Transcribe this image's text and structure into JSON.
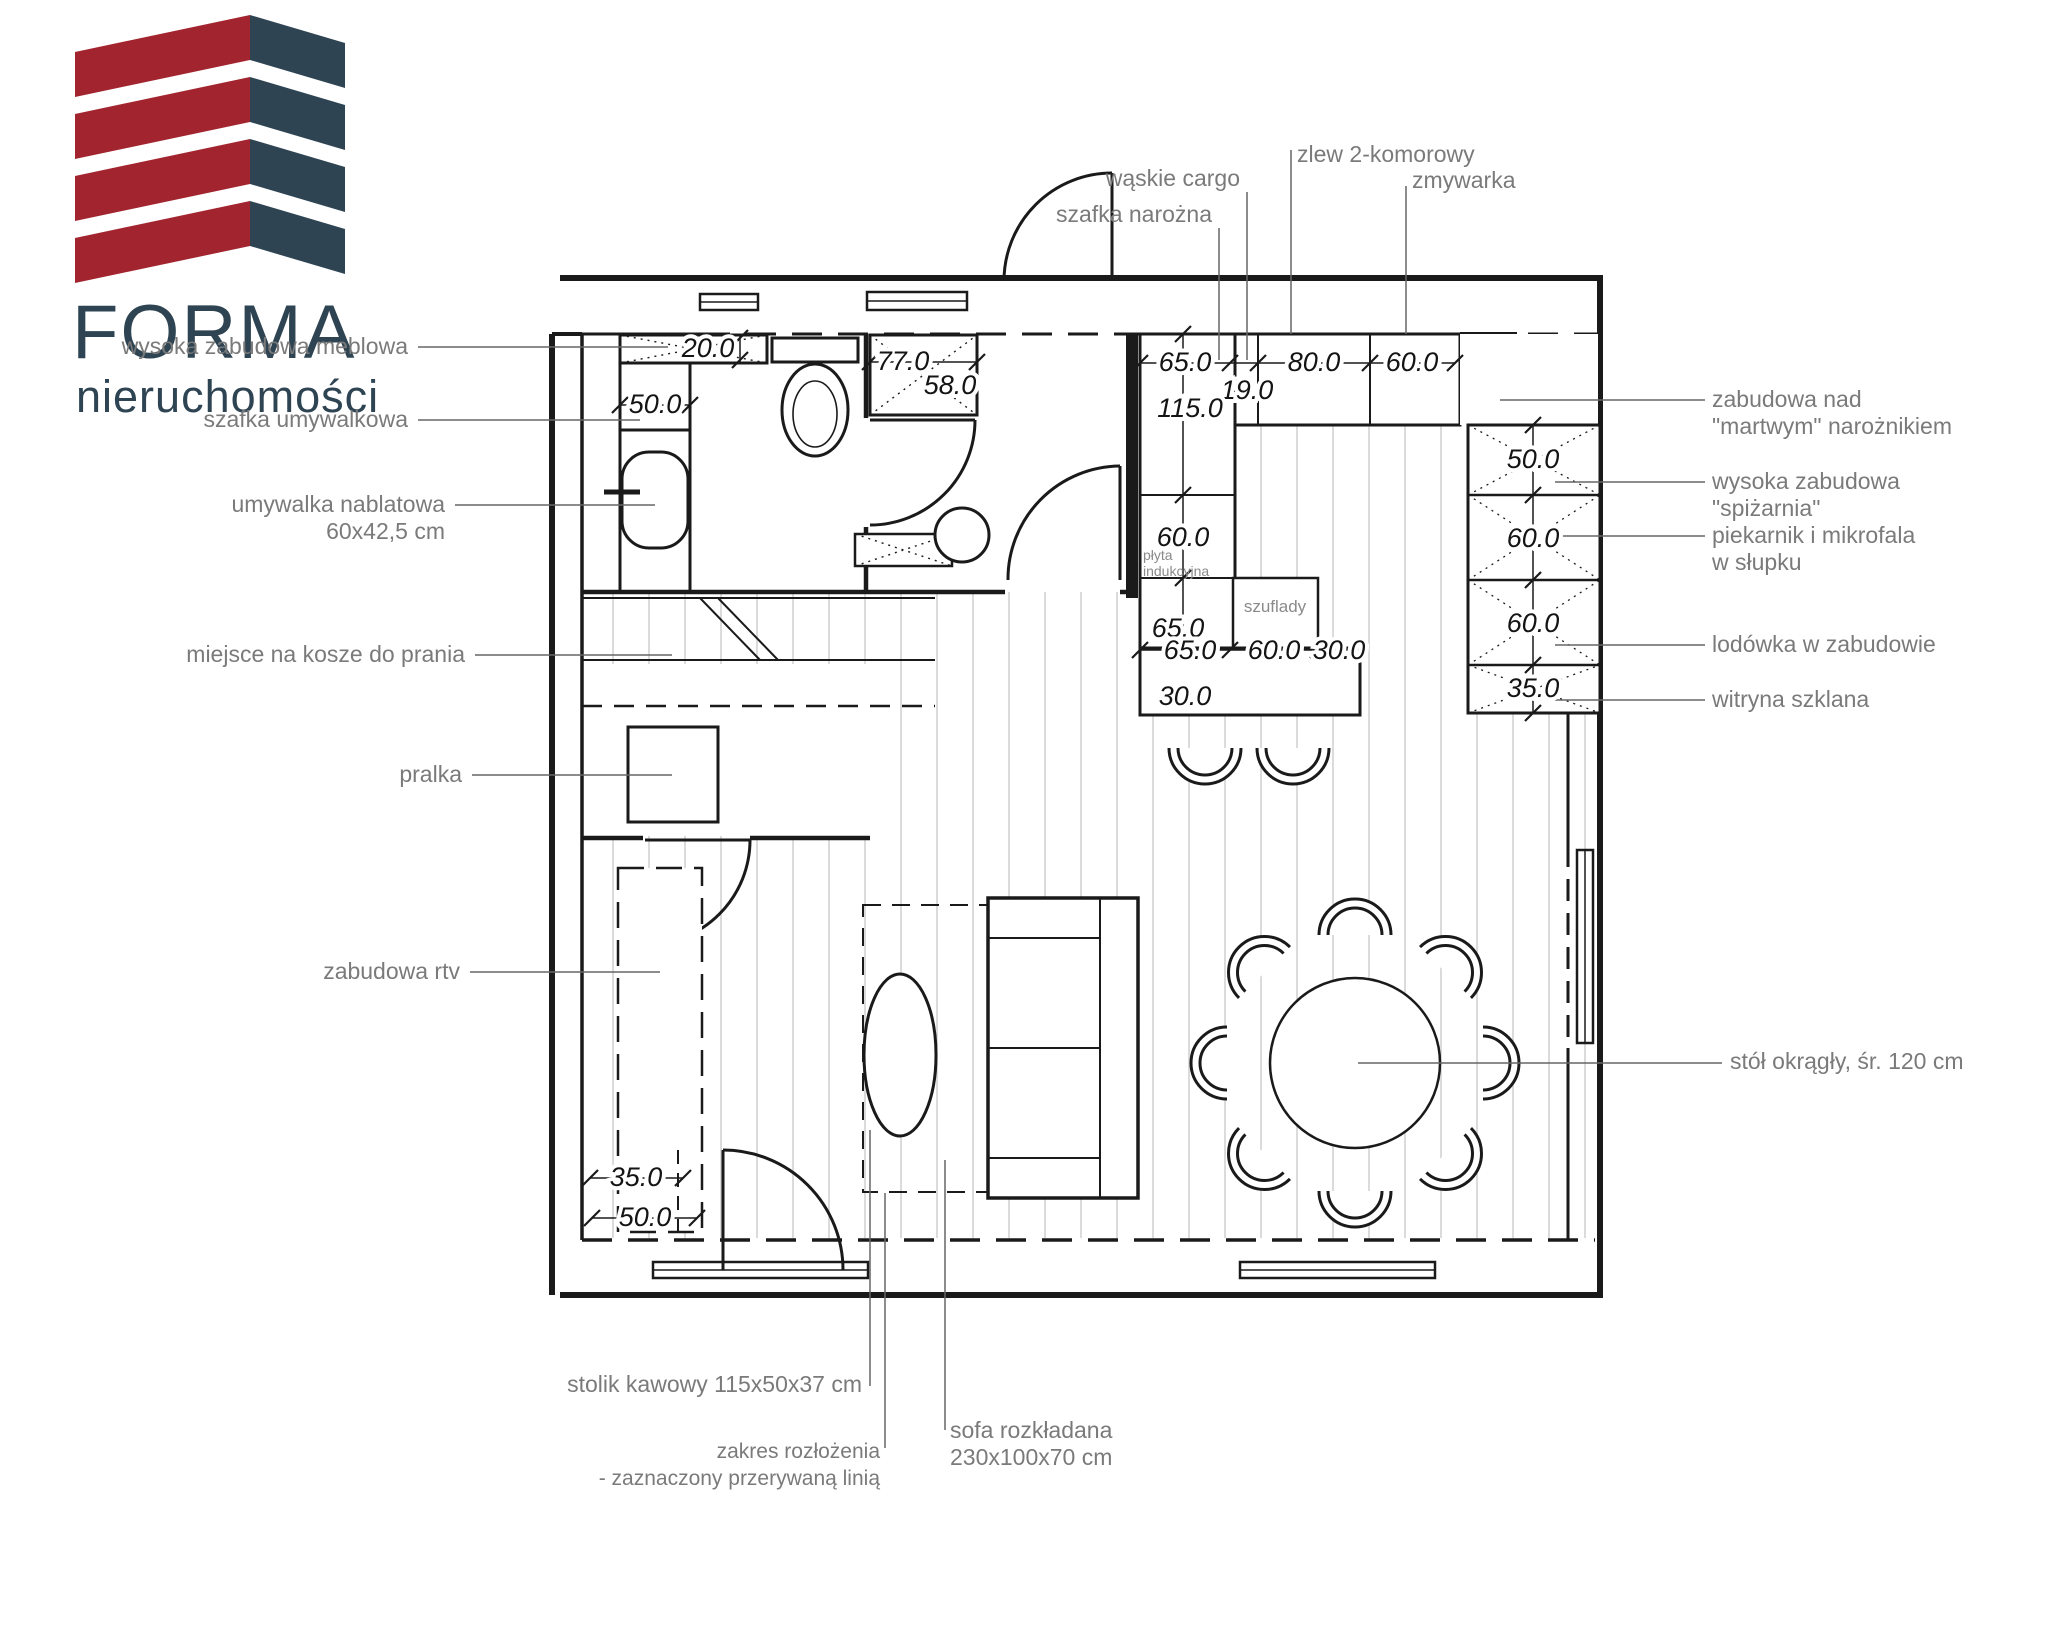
{
  "logo": {
    "title": "FORMA",
    "subtitle": "nieruchomości",
    "colors": {
      "red": "#A2242E",
      "navy": "#2E4453"
    }
  },
  "labels": {
    "left": {
      "wysoka_zabudowa_meblowa": "wysoka zabudowa meblowa",
      "szafka_umywalkowa": "szafka umywalkowa",
      "umywalka_nablatowa": "umywalka nablatowa",
      "umywalka_size": "60x42,5 cm",
      "miejsce_na_kosze": "miejsce na kosze do prania",
      "pralka": "pralka",
      "zabudowa_rtv": "zabudowa rtv"
    },
    "top": {
      "waskie_cargo": "wąskie cargo",
      "szafka_narozna": "szafka narożna",
      "zlew": "zlew 2-komorowy",
      "zmywarka": "zmywarka"
    },
    "right": {
      "zabudowa_nad_1": "zabudowa nad",
      "zabudowa_nad_2": "\"martwym\" narożnikiem",
      "wysoka_zabudowa_1": "wysoka zabudowa",
      "wysoka_zabudowa_2": "\"spiżarnia\"",
      "piekarnik_1": "piekarnik i mikrofala",
      "piekarnik_2": "w słupku",
      "lodowka": "lodówka w zabudowie",
      "witryna": "witryna szklana",
      "stol": "stół okrągły, śr. 120 cm"
    },
    "bottom": {
      "stolik": "stolik kawowy 115x50x37 cm",
      "zakres_1": "zakres rozłożenia",
      "zakres_2": "- zaznaczony przerywaną linią",
      "sofa_1": "sofa rozkładana",
      "sofa_2": "230x100x70 cm"
    },
    "inner": {
      "plyta_1": "płyta",
      "plyta_2": "indukcyjna",
      "szuflady": "szuflady"
    }
  },
  "dims": {
    "bath": {
      "cabinet": "20.0",
      "alcove": "50.0",
      "wardrobe_w": "77.0",
      "wardrobe_d": "58.0"
    },
    "top_row": [
      "65.0",
      "19.0",
      "80.0",
      "60.0"
    ],
    "left_col": [
      "115.0",
      "60.0",
      "65.0",
      "30.0"
    ],
    "island_row": [
      "65.0",
      "60.0",
      "30.0"
    ],
    "island_upper": "65.0",
    "right_col": [
      "50.0",
      "60.0",
      "60.0",
      "35.0"
    ],
    "balcony": {
      "a": "35.0",
      "b": "50.0"
    }
  }
}
